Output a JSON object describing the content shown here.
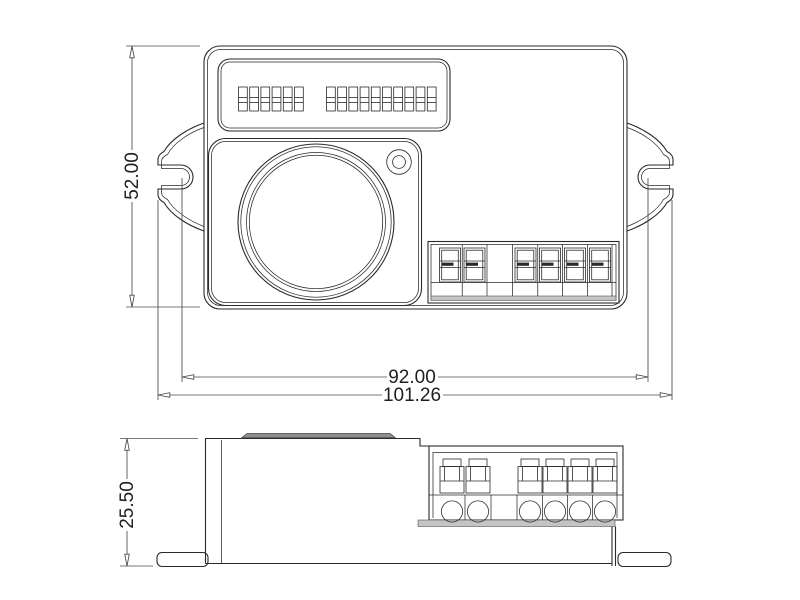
{
  "dimensions": {
    "front_height": "52.00",
    "mounting_width": "92.00",
    "overall_width": "101.26",
    "side_height": "25.50"
  },
  "front_view": {
    "dip_switches": {
      "groups": [
        6,
        10
      ]
    },
    "terminal_block": {
      "columns": 7,
      "occupied_columns": [
        1,
        2,
        4,
        5,
        6,
        7
      ]
    }
  },
  "side_view": {
    "push_terminals": 6,
    "wire_holes": 6
  },
  "colors": {
    "background": "#ffffff",
    "line": "#2a2a2a",
    "dim_line": "#4a4a4a",
    "shade": "#c4c4c4"
  }
}
